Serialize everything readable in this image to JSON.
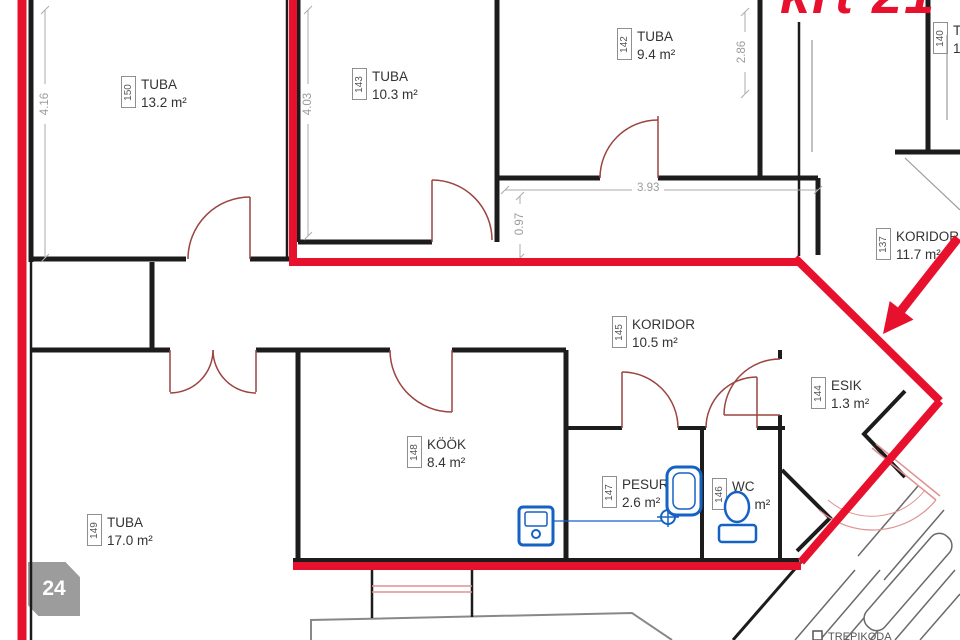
{
  "annotation": {
    "apartment": "krt 21"
  },
  "marker": {
    "number": "24"
  },
  "rooms": {
    "r150": {
      "id": "150",
      "name": "TUBA",
      "area": "13.2 m²"
    },
    "r143": {
      "id": "143",
      "name": "TUBA",
      "area": "10.3 m²"
    },
    "r142": {
      "id": "142",
      "name": "TUBA",
      "area": "9.4 m²"
    },
    "r140": {
      "id": "140",
      "name": "T",
      "area": "1"
    },
    "r137": {
      "id": "137",
      "name": "KORIDOR",
      "area": "11.7 m²"
    },
    "r145": {
      "id": "145",
      "name": "KORIDOR",
      "area": "10.5 m²"
    },
    "r144": {
      "id": "144",
      "name": "ESIK",
      "area": "1.3 m²"
    },
    "r148": {
      "id": "148",
      "name": "KÖÖK",
      "area": "8.4 m²"
    },
    "r147": {
      "id": "147",
      "name": "PESURUUM",
      "area": "2.6 m²"
    },
    "r146": {
      "id": "146",
      "name": "WC",
      "area": "1.1 m²"
    },
    "r149": {
      "id": "149",
      "name": "TUBA",
      "area": "17.0 m²"
    }
  },
  "dimensions": {
    "left_room_height": "4.16",
    "mid_room_height": "4.03",
    "hall_width": "3.93",
    "hall_depth": "0.97",
    "right_room_height": "2.86"
  },
  "stairs_label": "TREPIKODA",
  "colors": {
    "boundary_red": "#e8112d",
    "wall_black": "#1c1c1c",
    "door_swing_red": "#9b4440",
    "window_pink": "#e09090",
    "fixture_blue": "#1462c4",
    "dimension_gray": "#aaaaaa",
    "marker_gray": "#9c9c9c"
  }
}
